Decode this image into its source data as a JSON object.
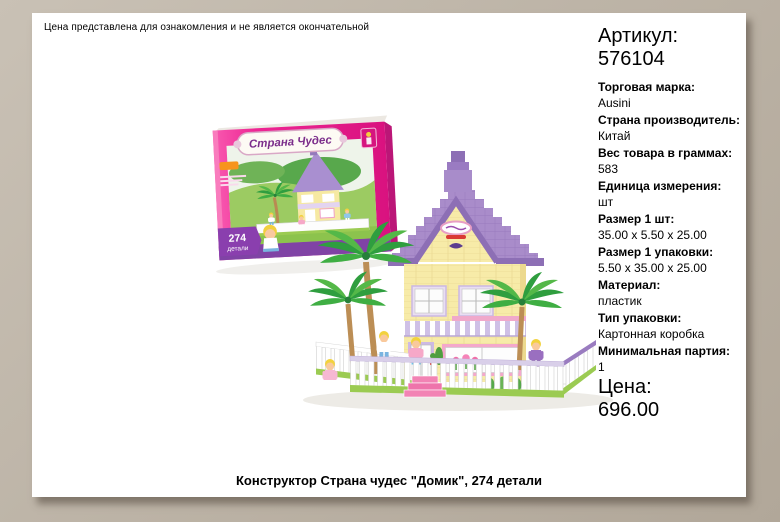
{
  "page": {
    "disclaimer": "Цена представлена для ознакомления и не является окончательной",
    "title": "Конструктор Страна чудес \"Домик\", 274 детали"
  },
  "product": {
    "article_label": "Артикул:",
    "article_value": "576104",
    "attributes": [
      {
        "label": "Торговая марка:",
        "value": "Ausini"
      },
      {
        "label": "Страна производитель:",
        "value": "Китай"
      },
      {
        "label": "Вес товара в граммах:",
        "value": "583"
      },
      {
        "label": "Единица измерения:",
        "value": "шт"
      },
      {
        "label": "Размер 1 шт:",
        "value": "35.00 x 5.50 x 25.00"
      },
      {
        "label": "Размер 1 упаковки:",
        "value": "5.50 x 35.00 x 25.00"
      },
      {
        "label": "Материал:",
        "value": "пластик"
      },
      {
        "label": "Тип упаковки:",
        "value": "Картонная коробка"
      },
      {
        "label": "Минимальная партия:",
        "value": "1"
      }
    ],
    "price_label": "Цена:",
    "price_value": "696.00"
  },
  "box_art": {
    "brand_banner": "Страна Чудес",
    "pieces_count": "274",
    "pieces_label": "детали"
  },
  "colors": {
    "frame": "#bdb4a7",
    "page": "#ffffff",
    "box_pink": "#ee2694",
    "box_purple": "#8043a5",
    "roof_purple": "#a98cca",
    "wall_yellow": "#f7eba8",
    "fence_green": "#9bcb52"
  }
}
